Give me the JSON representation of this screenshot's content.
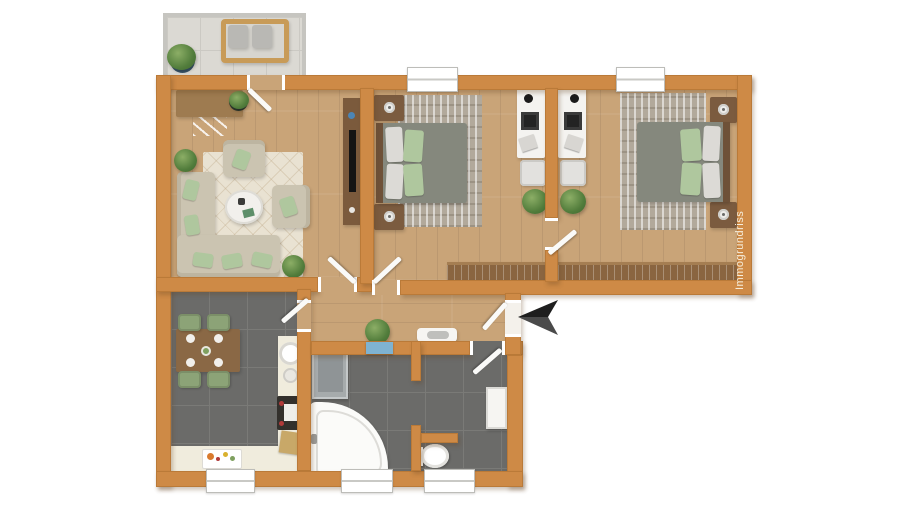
{
  "watermark": {
    "text": "Immogrundriss"
  },
  "palette": {
    "wall": "#CE8A46",
    "wall-edge": "#BA7A38",
    "wood": "#C9A478",
    "tile": "#6B6B69",
    "tile-line": "#7A7A77",
    "balcony": "#DBD9D3",
    "balcony-line": "#CBC9C3",
    "rug-living": "#E9E2D2",
    "rug-bedroom": "#B2A99B",
    "sofa": "#CBC4B1",
    "pillow-mint": "#AFC79E",
    "pillow-white": "#DCDAD6",
    "duvet": "#85887D",
    "wood-furniture": "#8A6540",
    "nightstand": "#7B5B3F",
    "counter": "#F0ECDD",
    "chair-green": "#8CA377",
    "fixture-white": "#F6F5F2",
    "washer-grey": "#A6ABAC",
    "shelf-blue": "#7FB3D1",
    "arrow-dark": "#1E1E1E",
    "arrow-mid": "#4A4A4A",
    "text-light": "#F6EEDC"
  }
}
